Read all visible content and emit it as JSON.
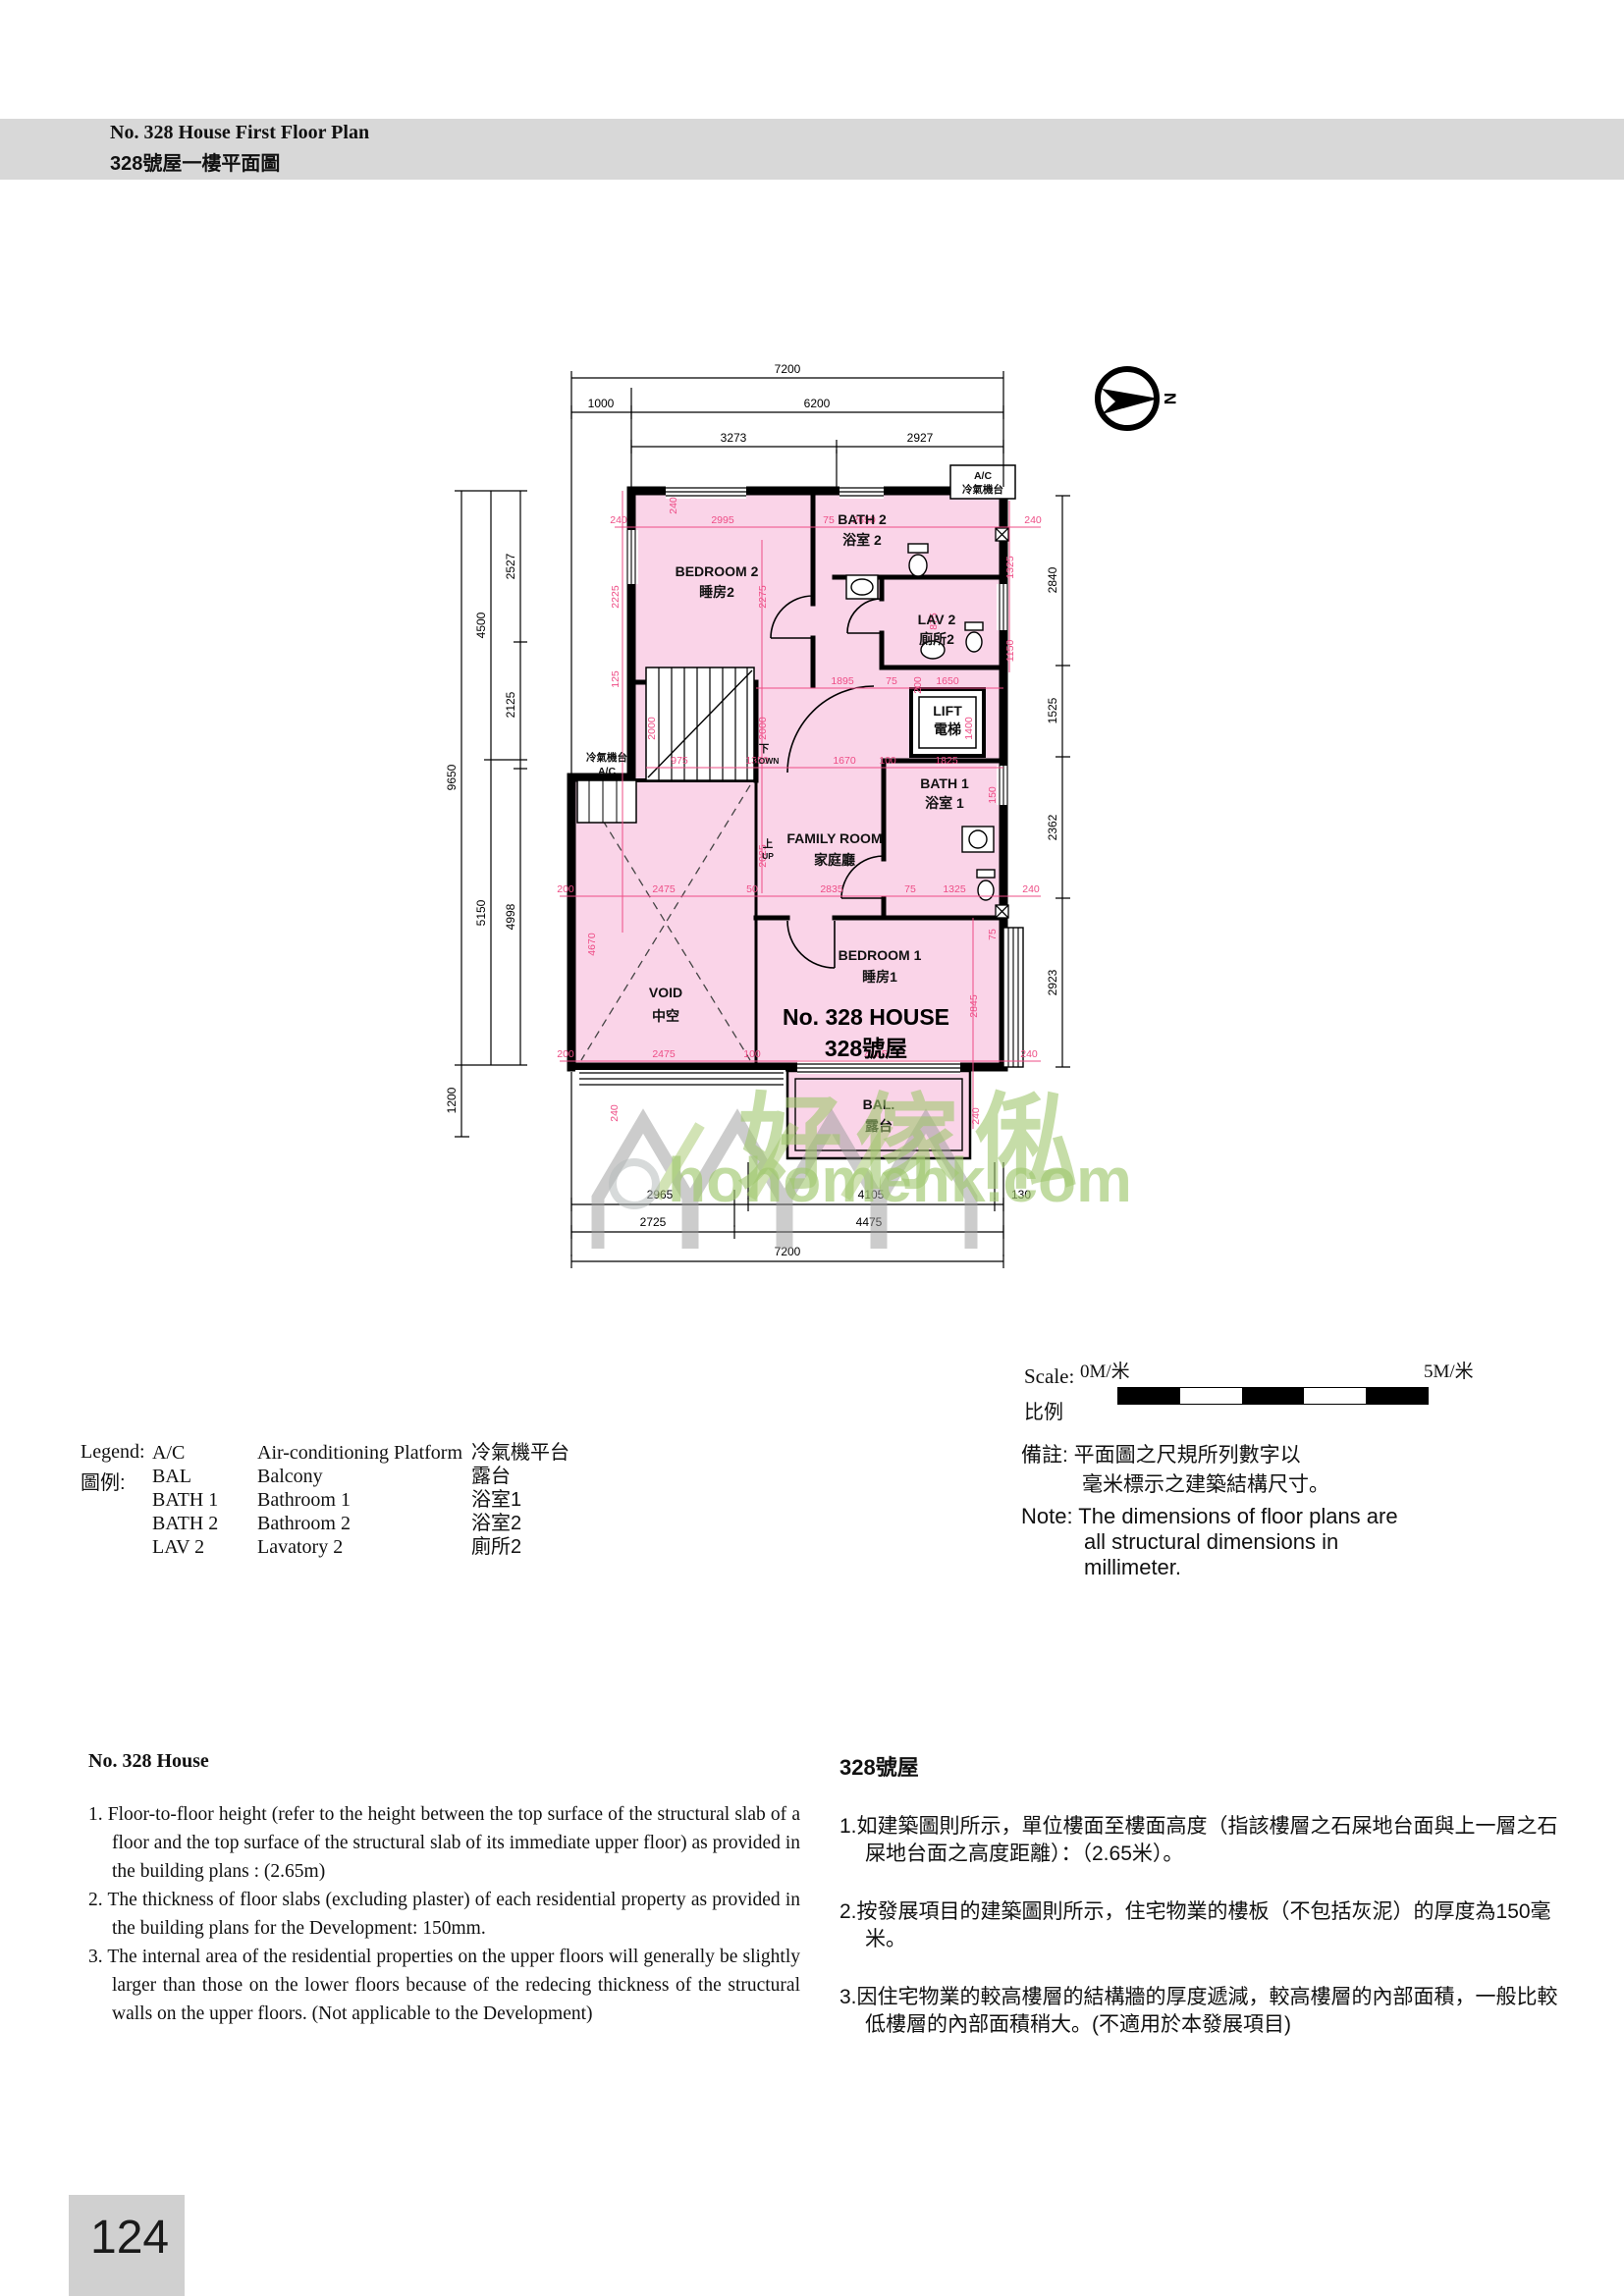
{
  "header": {
    "title_en": "No. 328 House First Floor Plan",
    "title_zh": "328號屋一樓平面圖"
  },
  "compass": {
    "label": "N"
  },
  "plan": {
    "house_name_en": "No. 328 HOUSE",
    "house_name_zh": "328號屋",
    "rooms": {
      "bedroom2_en": "BEDROOM 2",
      "bedroom2_zh": "睡房2",
      "bath2_en": "BATH 2",
      "bath2_zh": "浴室 2",
      "lav2_en": "LAV 2",
      "lav2_zh": "廁所2",
      "lift_en": "LIFT",
      "lift_zh": "電梯",
      "bath1_en": "BATH 1",
      "bath1_zh": "浴室 1",
      "family_en": "FAMILY ROOM",
      "family_zh": "家庭廳",
      "void_en": "VOID",
      "void_zh": "中空",
      "bedroom1_en": "BEDROOM 1",
      "bedroom1_zh": "睡房1",
      "bal_en": "BAL.",
      "bal_zh": "露台",
      "ac_top_en": "A/C",
      "ac_top_zh": "冷氣機台",
      "ac_left_zh": "冷氣機台",
      "ac_left_en": "A/C",
      "down_zh": "下",
      "down_en": "DOWN",
      "up_zh": "上",
      "up_en": "UP"
    },
    "dims": {
      "top": [
        "7200",
        "1000",
        "6200",
        "3273",
        "2927"
      ],
      "left": [
        "9650",
        "1200",
        "4500",
        "5150",
        "2527",
        "2125",
        "4998"
      ],
      "right": [
        "2840",
        "1525",
        "2362",
        "2923"
      ],
      "bottom": [
        "2965",
        "4105",
        "130",
        "2725",
        "4475",
        "7200"
      ]
    },
    "inner": [
      "240",
      "2995",
      "75",
      "2650",
      "240",
      "240",
      "2225",
      "2275",
      "1325",
      "875",
      "1150",
      "125",
      "200",
      "1895",
      "75",
      "1650",
      "2000",
      "2000",
      "1400",
      "150",
      "975",
      "1350",
      "1670",
      "100",
      "1825",
      "2025",
      "200",
      "2475",
      "50",
      "2835",
      "75",
      "1325",
      "240",
      "4670",
      "240",
      "200",
      "2475",
      "100",
      "4165",
      "240",
      "2845",
      "75",
      "240"
    ]
  },
  "scale_bar": {
    "label_en": "Scale:",
    "label_zh": "比例",
    "start": "0M/米",
    "end": "5M/米"
  },
  "legend": {
    "title_en": "Legend:",
    "title_zh": "圖例:",
    "items": [
      {
        "code": "A/C",
        "en": "Air-conditioning Platform",
        "zh": "冷氣機平台"
      },
      {
        "code": "BAL",
        "en": "Balcony",
        "zh": "露台"
      },
      {
        "code": "BATH 1",
        "en": "Bathroom 1",
        "zh": "浴室1"
      },
      {
        "code": "BATH 2",
        "en": "Bathroom 2",
        "zh": "浴室2"
      },
      {
        "code": "LAV 2",
        "en": "Lavatory 2",
        "zh": "廁所2"
      }
    ]
  },
  "note": {
    "zh_line1": "備註: 平面圖之尺規所列數字以",
    "zh_line2": "毫米標示之建築結構尺寸。",
    "en_line1": "Note: The dimensions of floor plans are",
    "en_line2": "all structural dimensions in",
    "en_line3": "millimeter."
  },
  "notes_en": {
    "title": "No. 328 House",
    "items": [
      "1. Floor-to-floor height (refer to the height between the top surface of the structural slab of a floor and the top surface of the structural slab of its immediate upper floor) as provided in the building plans : (2.65m)",
      "2. The thickness of floor slabs (excluding plaster) of each residential  property as provided in the building plans for the Development: 150mm.",
      "3. The internal area of the residential properties on the upper floors will generally be slightly larger than those on the lower floors because of the redecing thickness of the structural walls on the upper floors. (Not applicable to the Development)"
    ]
  },
  "notes_zh": {
    "title": "328號屋",
    "items": [
      "1.如建築圖則所示，單位樓面至樓面高度（指該樓層之石屎地台面與上一層之石屎地台面之高度距離）：（2.65米）。",
      "2.按發展項目的建築圖則所示，住宅物業的樓板（不包括灰泥）的厚度為150毫米。",
      "3.因住宅物業的較高樓層的結構牆的厚度遞減，較高樓層的內部面積，一般比較低樓層的內部面積稍大。(不適用於本發展項目)"
    ]
  },
  "watermark": {
    "logo_text": "好傢俬",
    "url_text": "hohomehk.com"
  },
  "page_number": "124",
  "colors": {
    "plan_fill": "#fad4e8",
    "dim_pink": "#ee4d86",
    "watermark_green": "#a0c76e"
  }
}
